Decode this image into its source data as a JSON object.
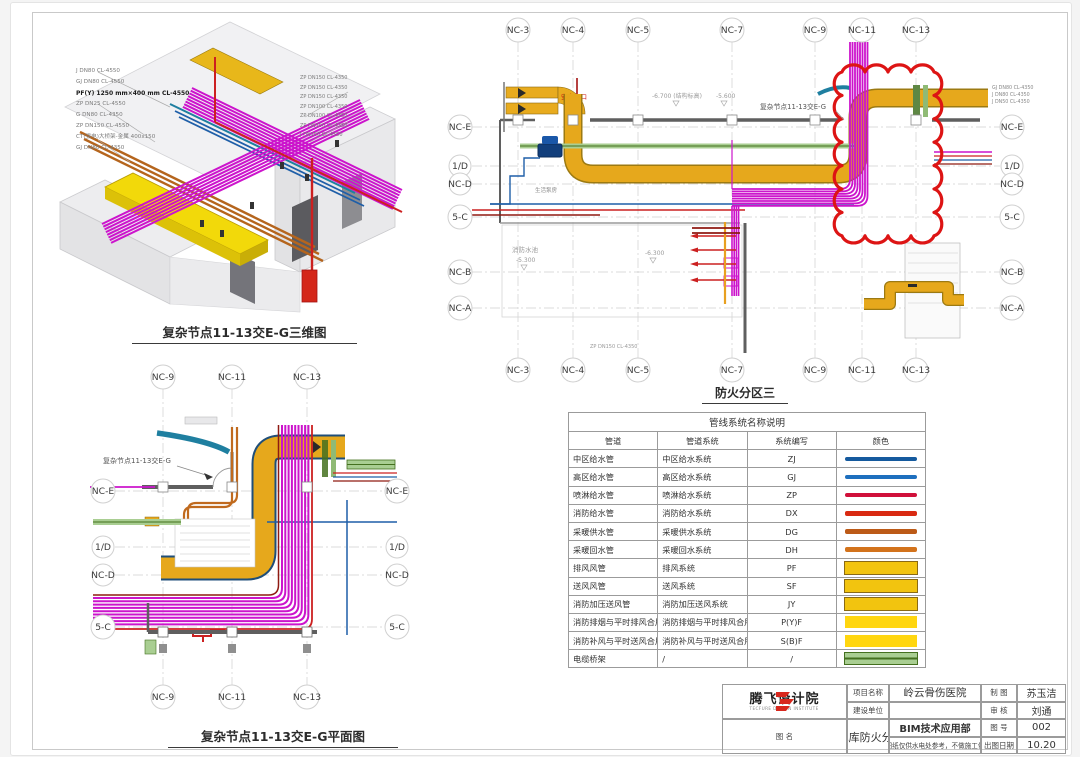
{
  "iso_view": {
    "caption": "复杂节点11-13交E-G三维图",
    "labels_left": [
      "J DN80 CL-4550",
      "GJ DN80 CL-4550",
      "PF(Y) 1250 mm×400 mm CL-4550",
      "ZP DN25 CL-4550",
      "G DN80 CL-4350",
      "ZP DN150 CL-4550",
      "CT(强电)大桥架-金属 400x150",
      "GJ DN80 CL-4350"
    ],
    "labels_right": [
      "ZP DN150 CL-4350",
      "ZP DN150 CL-4350",
      "ZP DN150 CL-4350",
      "ZP DN100 CL-4350",
      "ZP DN100 CL-4350",
      "ZP DN150 CL-4350",
      "J DN150 CL-4550"
    ]
  },
  "plan_main": {
    "caption": "防火分区三",
    "col_labels": [
      "NC-3",
      "NC-4",
      "NC-5",
      "NC-7",
      "NC-9",
      "NC-11",
      "NC-13"
    ],
    "row_labels": [
      "NC-E",
      "1/D",
      "NC-D",
      "5-C",
      "NC-B",
      "NC-A"
    ],
    "annotations": {
      "node_label": "复杂节点11-13交E-G",
      "exit": "安全出口",
      "elev_structure": "-6.700 (结构标高)",
      "elev_56": "-5.600",
      "pool": "消防水池",
      "elev_53": "-5.300",
      "elev_63": "-6.300",
      "pump_room": "生活泵房",
      "bottom_pipe_label": "ZP DN150 CL-4350",
      "right_pipe_labels": [
        "GJ DN80 CL-4350",
        "J DN80 CL-4350",
        "J DN50 CL-4350"
      ]
    }
  },
  "plan_detail": {
    "caption": "复杂节点11-13交E-G平面图",
    "col_labels": [
      "NC-9",
      "NC-11",
      "NC-13"
    ],
    "row_labels": [
      "NC-E",
      "1/D",
      "NC-D",
      "5-C"
    ],
    "node_label": "复杂节点11-13交E-G"
  },
  "legend": {
    "title": "管线系统名称说明",
    "headers": [
      "管道",
      "管道系统",
      "系统编写",
      "颜色"
    ],
    "rows": [
      {
        "pipe": "中区给水管",
        "system": "中区给水系统",
        "code": "ZJ",
        "style": "line",
        "color": "#155A9E"
      },
      {
        "pipe": "高区给水管",
        "system": "高区给水系统",
        "code": "GJ",
        "style": "line",
        "color": "#1E6FBE"
      },
      {
        "pipe": "喷淋给水管",
        "system": "喷淋给水系统",
        "code": "ZP",
        "style": "line",
        "color": "#D0103A"
      },
      {
        "pipe": "消防给水管",
        "system": "消防给水系统",
        "code": "DX",
        "style": "line",
        "color": "#D92A12"
      },
      {
        "pipe": "采暖供水管",
        "system": "采暖供水系统",
        "code": "DG",
        "style": "line",
        "color": "#BC5A17"
      },
      {
        "pipe": "采暖回水管",
        "system": "采暖回水系统",
        "code": "DH",
        "style": "line",
        "color": "#D3731C"
      },
      {
        "pipe": "排风风管",
        "system": "排风系统",
        "code": "PF",
        "style": "duct",
        "color": "#F2C40F",
        "border": "#8A6A14"
      },
      {
        "pipe": "送风风管",
        "system": "送风系统",
        "code": "SF",
        "style": "duct",
        "color": "#F2C40F",
        "border": "#8A6A14"
      },
      {
        "pipe": "消防加压送风管",
        "system": "消防加压送风系统",
        "code": "JY",
        "style": "duct",
        "color": "#F2C40F",
        "border": "#8A6A14"
      },
      {
        "pipe": "消防排烟与平时排风合用风管",
        "system": "消防排烟与平时排风合用系统",
        "code": "P(Y)F",
        "style": "rect",
        "color": "#FFD60F"
      },
      {
        "pipe": "消防补风与平时送风合用风管",
        "system": "消防补风与平时送风合用系统",
        "code": "S(B)F",
        "style": "rect",
        "color": "#FFD60F"
      },
      {
        "pipe": "电缆桥架",
        "system": "/",
        "code": "/",
        "style": "tray",
        "color": "#A9CE92",
        "line_color": "#44701F"
      }
    ]
  },
  "title_block": {
    "company": "腾飞设计院",
    "company_en": "TECFURE DESIGN INSTITUTE",
    "department": "BIM技术应用部",
    "note": "本图纸仅供水电处参考，不做施工依据",
    "fields": {
      "project_label": "项目名称",
      "project": "岭云骨伤医院",
      "client_label": "建设单位",
      "client": "",
      "drawing_label": "图  名",
      "drawing": "5#地库防火分区三",
      "draftsman_label": "制 图",
      "draftsman": "苏玉洁",
      "reviewer_label": "审 核",
      "reviewer": "刘通",
      "number_label": "图 号",
      "number": "002",
      "date_label": "出图日期",
      "date": "10.20"
    }
  }
}
